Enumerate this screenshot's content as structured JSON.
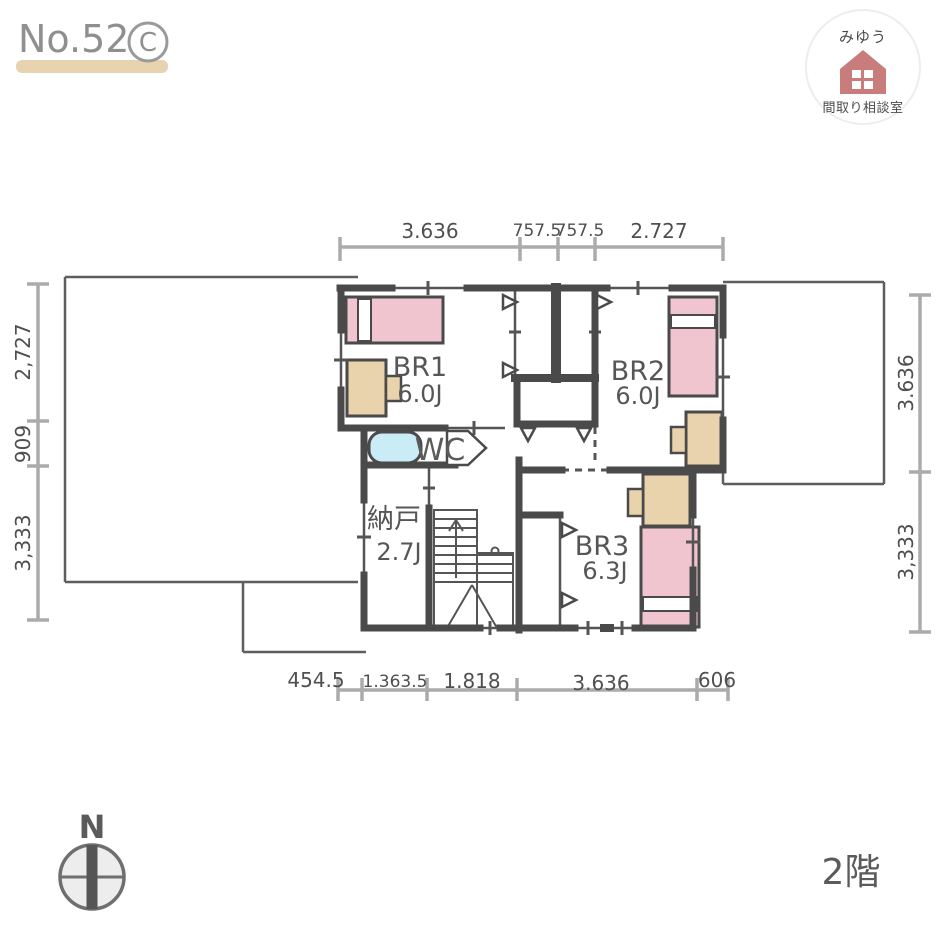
{
  "header": {
    "number": "No.52",
    "mark": "C"
  },
  "logo": {
    "name": "みゆう",
    "subtitle": "間取り相談室"
  },
  "floor_label": "2階",
  "compass": {
    "north": "N"
  },
  "rooms": {
    "br1": {
      "name": "BR1",
      "size": "6.0J"
    },
    "br2": {
      "name": "BR2",
      "size": "6.0J"
    },
    "br3": {
      "name": "BR3",
      "size": "6.3J"
    },
    "wc": {
      "name": "WC"
    },
    "storage": {
      "name": "納戸",
      "size": "2.7J"
    }
  },
  "dims": {
    "top": [
      "3.636",
      "757.5",
      "757.5",
      "2.727"
    ],
    "bottom": [
      "454.5",
      "1.363.5",
      "1.818",
      "3.636",
      "606"
    ],
    "left": [
      "2,727",
      "909",
      "3,333"
    ],
    "right": [
      "3.636",
      "3,333"
    ]
  },
  "colors": {
    "wall": "#4a4a4a",
    "bed": "#f0c5d0",
    "desk": "#e9d3ac",
    "toilet": "#c9ecf6",
    "logo_house": "#c97c7c",
    "underline": "#e8d3b1",
    "dim_line": "#ababab"
  }
}
